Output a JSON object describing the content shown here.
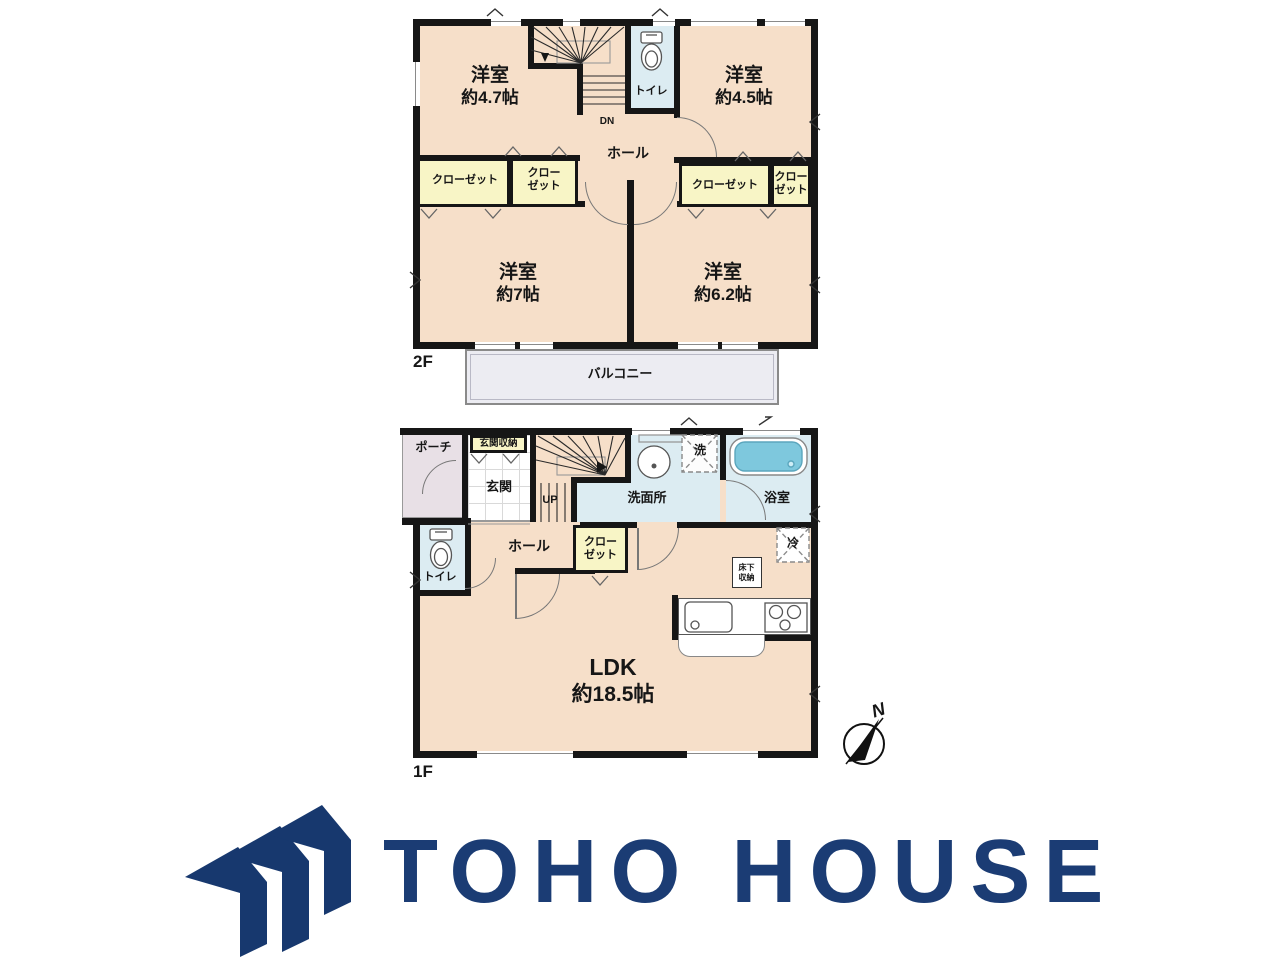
{
  "colors": {
    "wall": "#161616",
    "room": "#f6dfc9",
    "closet": "#f8f5c6",
    "wet": "#dcecf2",
    "water": "#7ec8dd",
    "porch": "#e8e0e6",
    "balcony": "#ececf2",
    "navy": "#1b3c74",
    "line": "#8a8a8a"
  },
  "floor2": {
    "floor_label": "2F",
    "rooms": {
      "b47": {
        "name": "洋室",
        "size": "約4.7帖"
      },
      "b45": {
        "name": "洋室",
        "size": "約4.5帖"
      },
      "b7": {
        "name": "洋室",
        "size": "約7帖"
      },
      "b62": {
        "name": "洋室",
        "size": "約6.2帖"
      }
    },
    "toilet": "トイレ",
    "hall": "ホール",
    "stairs_down": "DN",
    "closet": "クローゼット",
    "closet_line1": "クロー",
    "closet_line2": "ゼット",
    "balcony": "バルコニー"
  },
  "floor1": {
    "floor_label": "1F",
    "porch": "ポーチ",
    "entrance_storage": "玄関収納",
    "entrance": "玄関",
    "stairs_up": "UP",
    "washroom": "洗面所",
    "laundry": "洗",
    "bathroom": "浴室",
    "toilet": "トイレ",
    "hall": "ホール",
    "closet_line1": "クロー",
    "closet_line2": "ゼット",
    "underfloor_line1": "床下",
    "underfloor_line2": "収納",
    "refrigerator": "冷",
    "ldk_name": "LDK",
    "ldk_size": "約18.5帖",
    "compass_north": "N"
  },
  "logo": {
    "company": "TOHO HOUSE"
  }
}
